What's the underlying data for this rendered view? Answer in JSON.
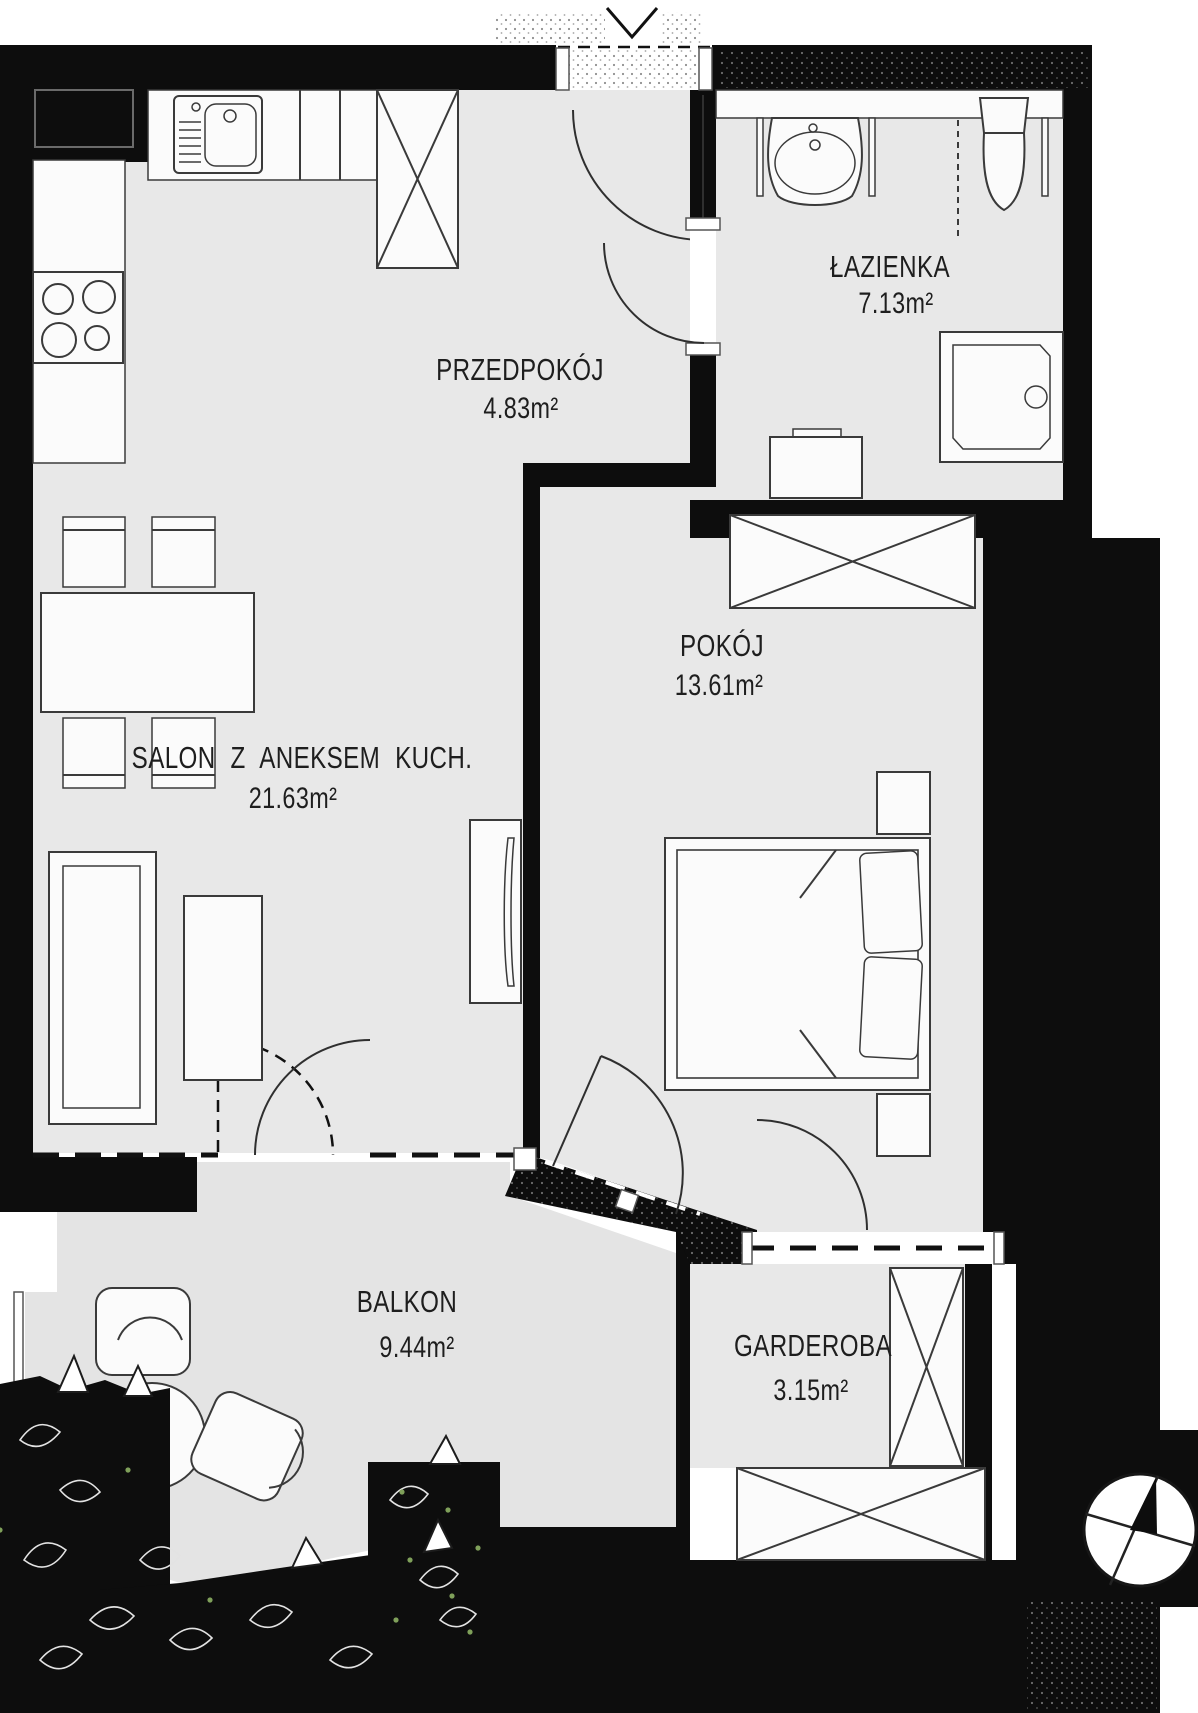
{
  "rooms": [
    {
      "id": "salon",
      "name": "SALON Z ANEKSEM KUCH.",
      "area": "21.63m²"
    },
    {
      "id": "przedpokoj",
      "name": "PRZEDPOKÓJ",
      "area": "4.83m²"
    },
    {
      "id": "pokoj",
      "name": "POKÓJ",
      "area": "13.61m²"
    },
    {
      "id": "lazienka",
      "name": "ŁAZIENKA",
      "area": "7.13m²"
    },
    {
      "id": "garderoba",
      "name": "GARDEROBA",
      "area": "3.15m²"
    },
    {
      "id": "balkon",
      "name": "BALKON",
      "area": "9.44m²"
    }
  ],
  "icons": {
    "north_arrow": "compass-north-arrow",
    "entrance_marker": "entrance-chevron"
  },
  "theme": {
    "wall": "#0d0d0d",
    "floor": "#e8e8e8",
    "floorb": "#e4e4e4",
    "line": "#3a3a3a",
    "furn": "#fbfbfb",
    "text": "#1e1e1e",
    "accent": "#7fa05a",
    "bg": "#ffffff"
  }
}
